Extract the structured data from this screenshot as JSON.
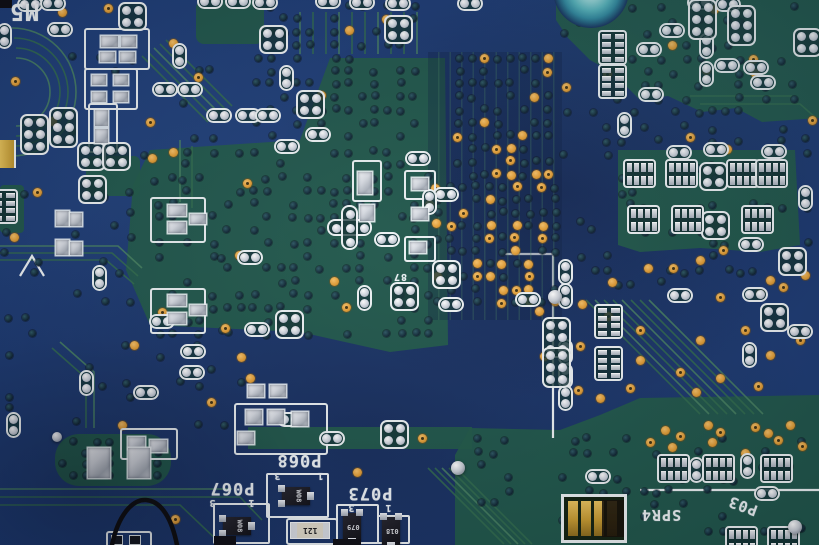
{
  "scene": {
    "description_label": "",
    "board_kind": "pcb-macro"
  },
  "colors": {
    "board_blue": "#1b3a74",
    "plane_green": "#1e5847",
    "trace_green": "#2f6b4b",
    "trace_light": "#47815f",
    "silk_white": "#eef3f5",
    "via_orange": "#e7a33c",
    "via_dark": "#0d2432",
    "pad_silver": "#ccd2dc",
    "teal_ring": "#55b5bd",
    "gold": "#d2a83c",
    "wire_black": "#0a0a0c"
  },
  "silkscreen_labels": [
    {
      "text": "M5",
      "x": 24,
      "y": 13,
      "rot": 180,
      "size": 23
    },
    {
      "text": "P068",
      "x": 299,
      "y": 461,
      "rot": 180,
      "size": 17
    },
    {
      "text": "3",
      "x": 277,
      "y": 476,
      "rot": 180,
      "size": 10
    },
    {
      "text": "1",
      "x": 320,
      "y": 476,
      "rot": 180,
      "size": 10
    },
    {
      "text": "P073",
      "x": 370,
      "y": 494,
      "rot": 180,
      "size": 17
    },
    {
      "text": "3",
      "x": 351,
      "y": 508,
      "rot": 180,
      "size": 10
    },
    {
      "text": "1",
      "x": 388,
      "y": 508,
      "rot": 180,
      "size": 10
    },
    {
      "text": "P067",
      "x": 232,
      "y": 489,
      "rot": 180,
      "size": 17
    },
    {
      "text": "3",
      "x": 212,
      "y": 503,
      "rot": 180,
      "size": 10
    },
    {
      "text": "1",
      "x": 251,
      "y": 503,
      "rot": 180,
      "size": 10
    },
    {
      "text": "SPR4",
      "x": 661,
      "y": 516,
      "rot": 180,
      "size": 15
    },
    {
      "text": "P03",
      "x": 743,
      "y": 507,
      "rot": 200,
      "size": 15
    },
    {
      "text": "87",
      "x": 400,
      "y": 277,
      "rot": 180,
      "size": 10
    }
  ],
  "planes": {
    "polys": [
      "556,0 819,0 819,118 762,122 736,108 702,112 668,96 640,100 612,72 590,60 568,38 556,20",
      "150,150 300,140 330,58 445,58 448,345 390,352 300,332 150,325 126,270 133,185",
      "248,427 472,427 472,449 248,449",
      "455,455 470,428 560,430 600,415 640,398 819,395 819,545 455,545",
      "618,150 795,150 800,245 760,252 700,248 640,252 618,245"
    ],
    "rects": [
      [
        55,
        434,
        116,
        52,
        24
      ],
      [
        0,
        185,
        24,
        48,
        4
      ],
      [
        86,
        156,
        54,
        40,
        6
      ],
      [
        196,
        0,
        68,
        44,
        8
      ]
    ]
  },
  "traces": [
    {
      "d": "M 16 58 A 34 34 0 0 1 16 126"
    },
    {
      "d": "M 16 48 A 44 44 0 0 1 16 136"
    },
    {
      "d": "M 14 38 A 54 54 0 0 1 14 146"
    },
    {
      "d": "M 12 28 A 64 64 0 0 1 12 156"
    },
    {
      "d": "M 142 56 L 208 122"
    },
    {
      "d": "M 148 52 L 214 118"
    },
    {
      "d": "M 154 48 L 220 114"
    },
    {
      "d": "M 160 44 L 226 110"
    },
    {
      "d": "M 166 40 L 232 106"
    },
    {
      "d": "M 0 246 L 118 246 L 142 268"
    },
    {
      "d": "M 0 253 L 112 253 L 138 276"
    },
    {
      "d": "M 0 260 L 106 260 L 134 284"
    },
    {
      "d": "M 60 342 L 94 372 L 94 428"
    },
    {
      "d": "M 52 348 L 86 378 L 86 428"
    },
    {
      "d": "M 586 300 L 700 414"
    },
    {
      "d": "M 595 300 L 709 414"
    },
    {
      "d": "M 604 300 L 718 414"
    },
    {
      "d": "M 613 300 L 727 414"
    },
    {
      "d": "M 622 300 L 736 414"
    },
    {
      "d": "M 631 300 L 745 414"
    },
    {
      "d": "M 640 300 L 754 414"
    },
    {
      "d": "M 649 300 L 763 414"
    },
    {
      "d": "M 428 468 L 504 544"
    },
    {
      "d": "M 435 468 L 511 544"
    },
    {
      "d": "M 442 468 L 518 544"
    },
    {
      "d": "M 449 468 L 525 544"
    },
    {
      "d": "M 456 468 L 532 544"
    },
    {
      "d": "M 0 489 L 232 489"
    },
    {
      "d": "M 0 497 L 240 497 L 262 520"
    },
    {
      "d": "M 0 505 L 180 505 L 222 545"
    },
    {
      "d": "M 300 12 L 300 54"
    },
    {
      "d": "M 313 12 L 313 54"
    },
    {
      "d": "M 326 12 L 326 54"
    },
    {
      "d": "M 339 12 L 339 54"
    },
    {
      "d": "M 352 12 L 352 54"
    },
    {
      "d": "M 365 12 L 365 54"
    },
    {
      "d": "M 378 12 L 378 54"
    },
    {
      "d": "M 391 12 L 391 54"
    },
    {
      "d": "M 404 12 L 404 54"
    },
    {
      "d": "M 417 12 L 417 54"
    },
    {
      "d": "M 690 96 L 792 96"
    },
    {
      "d": "M 700 104 L 800 104 L 816 118"
    },
    {
      "d": "M 180 140 L 180 202"
    },
    {
      "d": "M 192 146 L 192 208"
    }
  ],
  "silk_lines": [
    "M 553 252 L 553 438",
    "M 500 254 L 553 254",
    "M 640 490 L 819 490",
    "M 20 276 L 32 256 L 44 276"
  ],
  "wire_path": "M 112 545 C 118 516 132 499 146 500 C 162 501 172 520 177 545",
  "via_grids": [
    {
      "x0": 437,
      "y0": 187,
      "cols": 10,
      "rows": 10,
      "dx": 13.2,
      "dy": 12.8,
      "seed": 7,
      "pOrange": 0.33,
      "pDark": 0.45,
      "jit": 1.5
    },
    {
      "x0": 459,
      "y0": 58,
      "cols": 8,
      "rows": 10,
      "dx": 12.8,
      "dy": 13,
      "seed": 11,
      "pOrange": 0.16,
      "pDark": 0.55,
      "jit": 1.5
    },
    {
      "x0": 258,
      "y0": 6,
      "cols": 13,
      "rows": 11,
      "dx": 13,
      "dy": 13,
      "seed": 21,
      "pOrange": 0.02,
      "pDark": 0.5,
      "jit": 1.5
    },
    {
      "x0": 160,
      "y0": 152,
      "cols": 21,
      "rows": 15,
      "dx": 13.4,
      "dy": 13,
      "seed": 33,
      "pOrange": 0.02,
      "pDark": 0.42,
      "jit": 1.5
    },
    {
      "x0": 566,
      "y0": 8,
      "cols": 19,
      "rows": 9,
      "dx": 13.4,
      "dy": 13,
      "seed": 43,
      "pOrange": 0.03,
      "pDark": 0.3,
      "jit": 2
    },
    {
      "x0": 566,
      "y0": 128,
      "cols": 19,
      "rows": 13,
      "dx": 13.4,
      "dy": 13,
      "seed": 55,
      "pOrange": 0.0,
      "pDark": 0.22,
      "jit": 3
    },
    {
      "x0": 480,
      "y0": 440,
      "cols": 25,
      "rows": 8,
      "dx": 13.5,
      "dy": 13,
      "seed": 66,
      "pOrange": 0.0,
      "pDark": 0.22,
      "jit": 3
    },
    {
      "x0": 8,
      "y0": 60,
      "cols": 18,
      "rows": 28,
      "dx": 13.5,
      "dy": 13.5,
      "seed": 77,
      "pOrange": 0.0,
      "pDark": 0.12,
      "jit": 4
    },
    {
      "x0": 62,
      "y0": 442,
      "cols": 9,
      "rows": 4,
      "dx": 12,
      "dy": 11,
      "seed": 88,
      "pOrange": 0.0,
      "pDark": 0.5,
      "jit": 1
    }
  ],
  "vias_orange": [
    [
      108,
      8
    ],
    [
      62,
      12
    ],
    [
      15,
      81
    ],
    [
      52,
      121
    ],
    [
      150,
      122
    ],
    [
      173,
      43
    ],
    [
      198,
      77
    ],
    [
      152,
      158
    ],
    [
      37,
      192
    ],
    [
      14,
      237
    ],
    [
      247,
      183
    ],
    [
      241,
      357
    ],
    [
      162,
      312
    ],
    [
      134,
      345
    ],
    [
      225,
      328
    ],
    [
      250,
      378
    ],
    [
      211,
      402
    ],
    [
      122,
      425
    ],
    [
      175,
      519
    ],
    [
      357,
      472
    ],
    [
      422,
      438
    ],
    [
      612,
      282
    ],
    [
      608,
      316
    ],
    [
      582,
      304
    ],
    [
      580,
      346
    ],
    [
      539,
      311
    ],
    [
      544,
      356
    ],
    [
      648,
      268
    ],
    [
      673,
      268
    ],
    [
      700,
      260
    ],
    [
      723,
      250
    ],
    [
      770,
      280
    ],
    [
      783,
      287
    ],
    [
      805,
      275
    ],
    [
      720,
      297
    ],
    [
      760,
      293
    ],
    [
      690,
      137
    ],
    [
      727,
      149
    ],
    [
      812,
      120
    ],
    [
      706,
      70
    ],
    [
      640,
      330
    ],
    [
      700,
      340
    ],
    [
      745,
      330
    ],
    [
      770,
      355
    ],
    [
      800,
      340
    ],
    [
      640,
      360
    ],
    [
      680,
      372
    ],
    [
      720,
      378
    ],
    [
      758,
      386
    ],
    [
      696,
      392
    ],
    [
      630,
      388
    ],
    [
      600,
      398
    ],
    [
      578,
      390
    ],
    [
      665,
      430
    ],
    [
      680,
      436
    ],
    [
      672,
      447
    ],
    [
      650,
      442
    ],
    [
      708,
      425
    ],
    [
      720,
      432
    ],
    [
      712,
      442
    ],
    [
      755,
      427
    ],
    [
      768,
      433
    ],
    [
      778,
      440
    ],
    [
      790,
      425
    ],
    [
      802,
      446
    ],
    [
      745,
      453
    ]
  ],
  "capsules": [
    [
      210,
      2,
      "h"
    ],
    [
      238,
      2,
      "h"
    ],
    [
      265,
      3,
      "h"
    ],
    [
      328,
      2,
      "h"
    ],
    [
      362,
      3,
      "h"
    ],
    [
      398,
      4,
      "h"
    ],
    [
      470,
      4,
      "h"
    ],
    [
      700,
      3,
      "h"
    ],
    [
      728,
      5,
      "h"
    ],
    [
      30,
      5,
      "h"
    ],
    [
      53,
      4,
      "h"
    ],
    [
      60,
      30,
      "h"
    ],
    [
      5,
      36,
      "v"
    ],
    [
      180,
      56,
      "v"
    ],
    [
      165,
      90,
      "h"
    ],
    [
      190,
      90,
      "h"
    ],
    [
      219,
      116,
      "h"
    ],
    [
      248,
      116,
      "h"
    ],
    [
      268,
      116,
      "h"
    ],
    [
      287,
      78,
      "v"
    ],
    [
      318,
      135,
      "h"
    ],
    [
      287,
      147,
      "h"
    ],
    [
      418,
      159,
      "h"
    ],
    [
      446,
      195,
      "h"
    ],
    [
      430,
      202,
      "v"
    ],
    [
      387,
      240,
      "h"
    ],
    [
      365,
      298,
      "v"
    ],
    [
      451,
      305,
      "h"
    ],
    [
      528,
      300,
      "h"
    ],
    [
      566,
      272,
      "v"
    ],
    [
      566,
      296,
      "v"
    ],
    [
      566,
      352,
      "v"
    ],
    [
      566,
      376,
      "v"
    ],
    [
      566,
      398,
      "v"
    ],
    [
      625,
      125,
      "v"
    ],
    [
      649,
      50,
      "h"
    ],
    [
      672,
      31,
      "h"
    ],
    [
      707,
      46,
      "v"
    ],
    [
      707,
      74,
      "v"
    ],
    [
      727,
      66,
      "h"
    ],
    [
      756,
      68,
      "h"
    ],
    [
      763,
      83,
      "h"
    ],
    [
      651,
      95,
      "h"
    ],
    [
      679,
      153,
      "h"
    ],
    [
      716,
      150,
      "h"
    ],
    [
      774,
      152,
      "h"
    ],
    [
      806,
      198,
      "v"
    ],
    [
      751,
      245,
      "h"
    ],
    [
      680,
      296,
      "h"
    ],
    [
      755,
      295,
      "h"
    ],
    [
      800,
      332,
      "h"
    ],
    [
      750,
      355,
      "v"
    ],
    [
      162,
      322,
      "h"
    ],
    [
      257,
      330,
      "h"
    ],
    [
      193,
      352,
      "h"
    ],
    [
      192,
      373,
      "h"
    ],
    [
      146,
      393,
      "h"
    ],
    [
      87,
      383,
      "v"
    ],
    [
      100,
      278,
      "v"
    ],
    [
      14,
      425,
      "v"
    ],
    [
      290,
      420,
      "h"
    ],
    [
      332,
      439,
      "h"
    ],
    [
      598,
      477,
      "h"
    ],
    [
      697,
      470,
      "v"
    ],
    [
      748,
      466,
      "v"
    ],
    [
      767,
      494,
      "h"
    ],
    [
      250,
      258,
      "h"
    ]
  ],
  "clusters": [
    [
      133,
      17,
      "4"
    ],
    [
      274,
      40,
      "4"
    ],
    [
      311,
      105,
      "4"
    ],
    [
      399,
      30,
      "4"
    ],
    [
      92,
      157,
      "4"
    ],
    [
      117,
      157,
      "4"
    ],
    [
      93,
      190,
      "4"
    ],
    [
      775,
      318,
      "4"
    ],
    [
      793,
      262,
      "4"
    ],
    [
      714,
      177,
      "4"
    ],
    [
      716,
      226,
      "4"
    ],
    [
      290,
      325,
      "4"
    ],
    [
      447,
      275,
      "4"
    ],
    [
      405,
      297,
      "4"
    ],
    [
      395,
      435,
      "4"
    ],
    [
      808,
      43,
      "4"
    ],
    [
      35,
      135,
      "6"
    ],
    [
      64,
      128,
      "6"
    ],
    [
      557,
      338,
      "6"
    ],
    [
      557,
      368,
      "6"
    ],
    [
      703,
      20,
      "6"
    ],
    [
      742,
      26,
      "6"
    ],
    [
      350,
      228,
      "plus"
    ]
  ],
  "ics": [
    [
      640,
      174,
      "A"
    ],
    [
      682,
      174,
      "A"
    ],
    [
      743,
      174,
      "A"
    ],
    [
      772,
      174,
      "A"
    ],
    [
      644,
      220,
      "A"
    ],
    [
      688,
      220,
      "A"
    ],
    [
      758,
      220,
      "A"
    ],
    [
      674,
      469,
      "A"
    ],
    [
      719,
      469,
      "A"
    ],
    [
      777,
      469,
      "A"
    ],
    [
      742,
      541,
      "A"
    ],
    [
      784,
      541,
      "A"
    ],
    [
      613,
      48,
      "B"
    ],
    [
      613,
      82,
      "B"
    ],
    [
      609,
      322,
      "B"
    ],
    [
      609,
      364,
      "B"
    ],
    [
      4,
      207,
      "B"
    ]
  ],
  "solder_rects": [
    [
      101,
      36,
      17,
      11
    ],
    [
      121,
      36,
      15,
      11
    ],
    [
      100,
      52,
      15,
      10
    ],
    [
      120,
      52,
      15,
      10
    ],
    [
      92,
      75,
      14,
      10
    ],
    [
      114,
      75,
      14,
      10
    ],
    [
      92,
      92,
      14,
      10
    ],
    [
      114,
      92,
      14,
      10
    ],
    [
      95,
      110,
      13,
      16
    ],
    [
      95,
      129,
      13,
      14
    ],
    [
      56,
      211,
      13,
      15
    ],
    [
      56,
      240,
      13,
      15
    ],
    [
      70,
      213,
      12,
      13
    ],
    [
      70,
      242,
      12,
      13
    ],
    [
      168,
      205,
      18,
      11
    ],
    [
      168,
      222,
      18,
      11
    ],
    [
      190,
      214,
      16,
      10
    ],
    [
      168,
      295,
      18,
      11
    ],
    [
      168,
      313,
      18,
      11
    ],
    [
      190,
      305,
      16,
      10
    ],
    [
      358,
      172,
      14,
      22
    ],
    [
      412,
      178,
      16,
      12
    ],
    [
      412,
      208,
      16,
      12
    ],
    [
      410,
      242,
      16,
      11
    ],
    [
      248,
      385,
      16,
      12
    ],
    [
      270,
      385,
      16,
      12
    ],
    [
      246,
      410,
      16,
      14
    ],
    [
      268,
      410,
      16,
      14
    ],
    [
      292,
      412,
      16,
      14
    ],
    [
      238,
      432,
      16,
      12
    ],
    [
      128,
      437,
      17,
      12
    ],
    [
      150,
      440,
      17,
      12
    ],
    [
      88,
      448,
      22,
      30
    ],
    [
      128,
      448,
      22,
      30
    ],
    [
      360,
      205,
      14,
      16
    ]
  ],
  "outline_boxes": [
    [
      84,
      28,
      62,
      38
    ],
    [
      84,
      68,
      50,
      38
    ],
    [
      88,
      103,
      26,
      46
    ],
    [
      150,
      197,
      52,
      42
    ],
    [
      150,
      288,
      52,
      42
    ],
    [
      352,
      160,
      26,
      38
    ],
    [
      404,
      170,
      28,
      26
    ],
    [
      234,
      403,
      90,
      48
    ],
    [
      120,
      428,
      54,
      28
    ],
    [
      404,
      236,
      28,
      22
    ]
  ],
  "sot23s": [
    {
      "x": 296,
      "y": 496,
      "vert": false,
      "mark": "W08",
      "box": [
        266,
        473,
        64,
        46
      ]
    },
    {
      "x": 237,
      "y": 526,
      "vert": false,
      "mark": "W08",
      "box": [
        213,
        503,
        58,
        42
      ]
    },
    {
      "x": 352,
      "y": 527,
      "vert": true,
      "mark": "079",
      "box": [
        336,
        504,
        44,
        41
      ]
    },
    {
      "x": 391,
      "y": 531,
      "vert": true,
      "mark": "018",
      "box": [
        377,
        515,
        34,
        30
      ]
    }
  ],
  "resistor": {
    "cx": 309,
    "cy": 529,
    "w": 38,
    "h": 15,
    "box": [
      286,
      518,
      48,
      23
    ],
    "text": "121"
  },
  "gold_connector": {
    "box": [
      561,
      494,
      66,
      49
    ]
  },
  "gold_edge_part": {
    "rect": [
      0,
      140,
      14,
      28
    ]
  },
  "teal_circle": {
    "cx": 591,
    "cy": -10,
    "r": 38
  },
  "balls": [
    [
      57,
      437,
      5
    ],
    [
      555,
      297,
      7
    ],
    [
      458,
      468,
      7
    ],
    [
      795,
      527,
      7
    ]
  ],
  "misc_black": [
    [
      214,
      536,
      22,
      9
    ],
    [
      333,
      539,
      28,
      6
    ],
    [
      0,
      0,
      12,
      8
    ]
  ],
  "bottom_edge_box": {
    "rect": [
      106,
      531,
      42,
      14
    ]
  }
}
